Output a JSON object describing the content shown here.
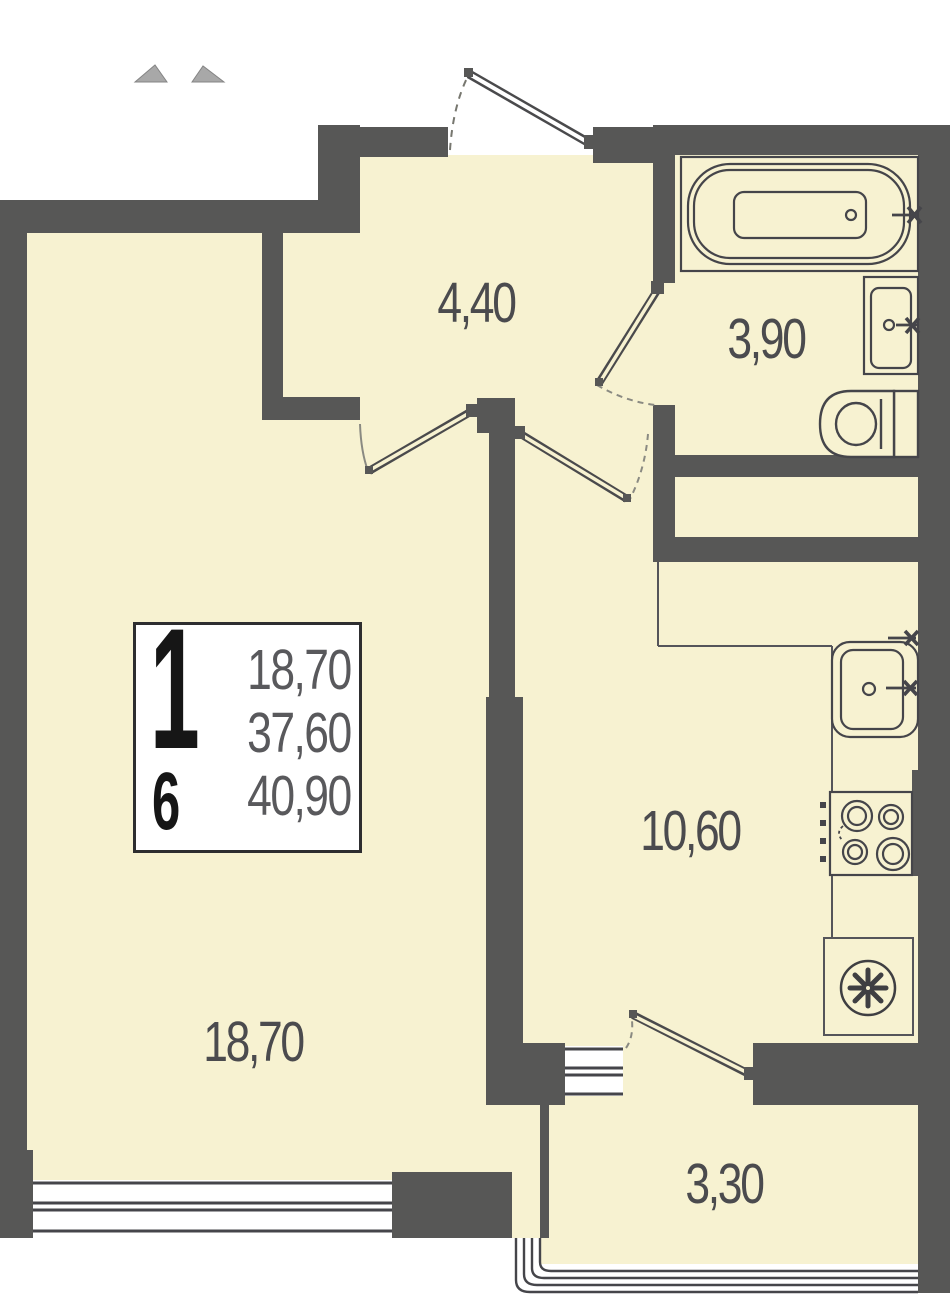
{
  "plan": {
    "rooms": [
      {
        "id": "hallway",
        "area": "4,40"
      },
      {
        "id": "bathroom",
        "area": "3,90"
      },
      {
        "id": "kitchen",
        "area": "10,60"
      },
      {
        "id": "living-room",
        "area": "18,70"
      },
      {
        "id": "balcony",
        "area": "3,30"
      }
    ],
    "info_box": {
      "rooms_count": "1",
      "floor": "6",
      "living_area": "18,70",
      "area_without_balcony": "37,60",
      "total_area": "40,90"
    },
    "fixtures": [
      "bathtub",
      "bathroom-sink",
      "toilet",
      "kitchen-sink",
      "stove",
      "vent-fan"
    ],
    "colors": {
      "wall": "#575756",
      "floor": "#F7F2D1",
      "line": "#45454a",
      "arc": "#8a8a82",
      "text": "#4b4b4e",
      "info_text": "#59595c",
      "white": "#ffffff"
    }
  }
}
